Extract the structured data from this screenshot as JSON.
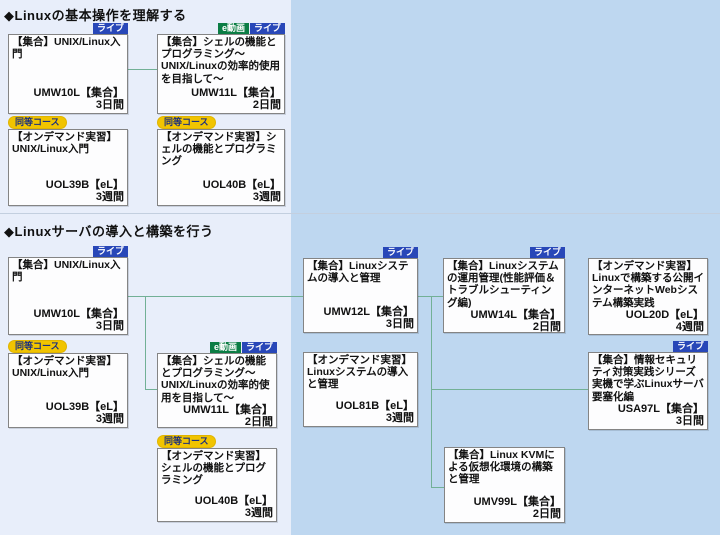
{
  "page": {
    "background_color": "#bed7f0",
    "panel_color": "#e8eefa",
    "connector_color": "#72b096",
    "badge_colors": {
      "live": "#2847b8",
      "evideo": "#0b7d44",
      "equivalent": "#f1c400"
    }
  },
  "sections": [
    {
      "title": "◆Linuxの基本操作を理解する"
    },
    {
      "title": "◆Linuxサーバの導入と構築を行う"
    }
  ],
  "badges": {
    "live": "ライブ",
    "evideo": "e動画",
    "equivalent": "同等コース"
  },
  "courses": [
    {
      "title": "【集合】UNIX/Linux入門",
      "code": "UMW10L【集合】",
      "duration": "3日間"
    },
    {
      "title": "【集合】シェルの機能とプログラミング～UNIX/Linuxの効率的使用を目指して～",
      "code": "UMW11L【集合】",
      "duration": "2日間"
    },
    {
      "title": "【オンデマンド実習】UNIX/Linux入門",
      "code": "UOL39B【eL】",
      "duration": "3週間"
    },
    {
      "title": "【オンデマンド実習】シェルの機能とプログラミング",
      "code": "UOL40B【eL】",
      "duration": "3週間"
    },
    {
      "title": "【集合】UNIX/Linux入門",
      "code": "UMW10L【集合】",
      "duration": "3日間"
    },
    {
      "title": "【オンデマンド実習】UNIX/Linux入門",
      "code": "UOL39B【eL】",
      "duration": "3週間"
    },
    {
      "title": "【集合】シェルの機能とプログラミング～UNIX/Linuxの効率的使用を目指して～",
      "code": "UMW11L【集合】",
      "duration": "2日間"
    },
    {
      "title": "【オンデマンド実習】シェルの機能とプログラミング",
      "code": "UOL40B【eL】",
      "duration": "3週間"
    },
    {
      "title": "【集合】Linuxシステムの導入と管理",
      "code": "UMW12L【集合】",
      "duration": "3日間"
    },
    {
      "title": "【オンデマンド実習】Linuxシステムの導入と管理",
      "code": "UOL81B【eL】",
      "duration": "3週間"
    },
    {
      "title": "【集合】Linuxシステムの運用管理(性能評価＆トラブルシューティング編)",
      "code": "UMW14L【集合】",
      "duration": "2日間"
    },
    {
      "title": "【オンデマンド実習】Linuxで構築する公開インターネットWebシステム構築実践",
      "code": "UOL20D【eL】",
      "duration": "4週間"
    },
    {
      "title": "【集合】情報セキュリティ対策実践シリーズ　実機で学ぶLinuxサーバ要塞化編",
      "code": "USA97L【集合】",
      "duration": "3日間"
    },
    {
      "title": "【集合】Linux KVMによる仮想化環境の構築と管理",
      "code": "UMV99L【集合】",
      "duration": "2日間"
    }
  ]
}
